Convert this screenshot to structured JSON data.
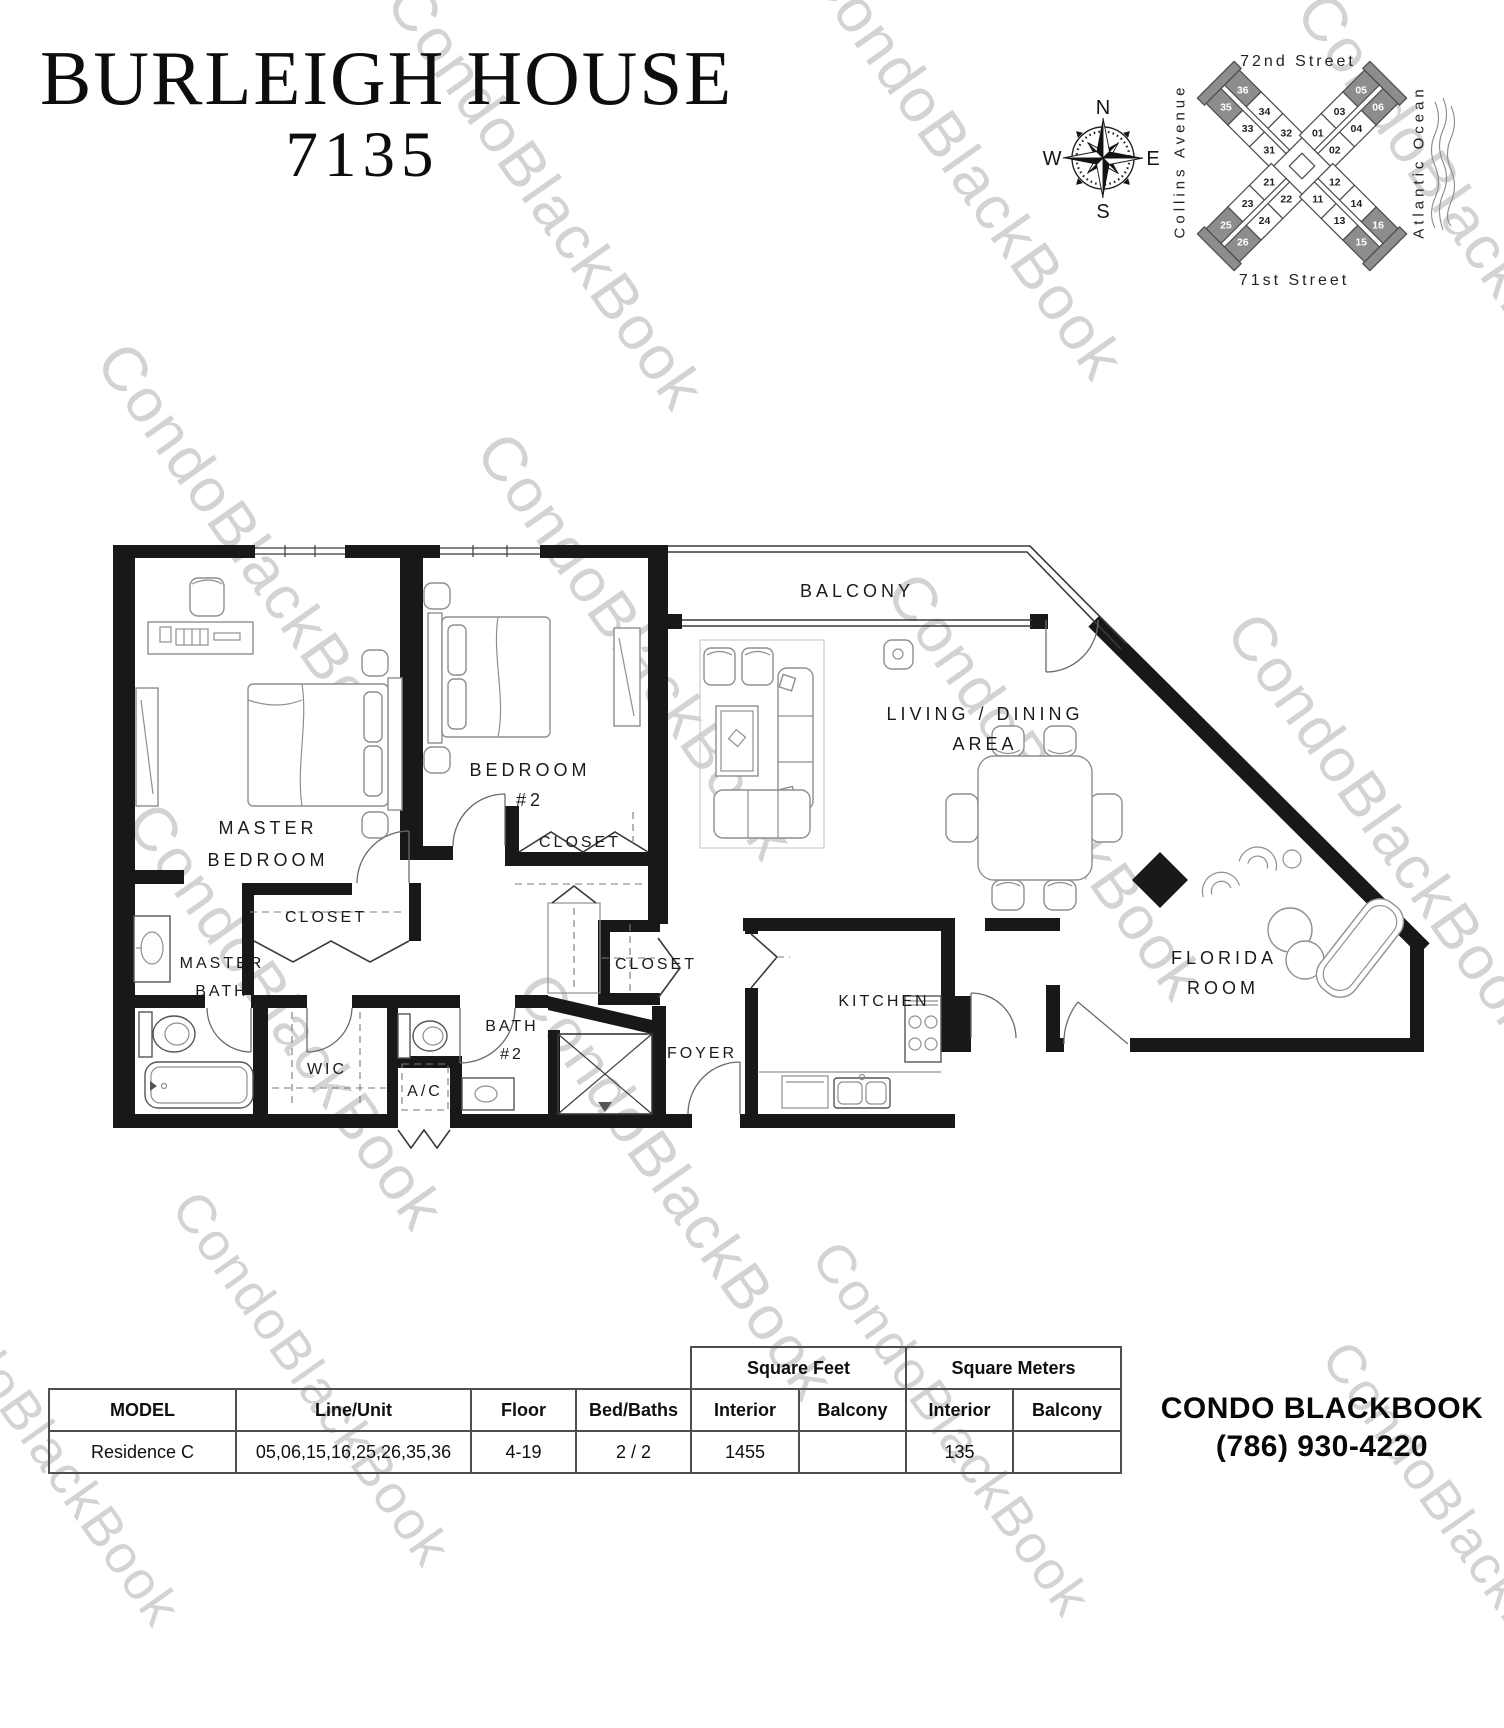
{
  "title": {
    "line1": "BURLEIGH HOUSE",
    "line2": "7135"
  },
  "watermark_text": "CondoBlackBook",
  "compass": {
    "north": "N",
    "east": "E",
    "south": "S",
    "west": "W"
  },
  "map": {
    "street_top": "72nd Street",
    "street_bottom": "71st Street",
    "street_left": "Collins Avenue",
    "ocean_right": "Atlantic Ocean",
    "building": {
      "highlighted_units": [
        "05",
        "06",
        "15",
        "16",
        "25",
        "26",
        "35",
        "36"
      ],
      "dark_color": "#8d8d8d",
      "arms": [
        {
          "angle": -45,
          "left": [
            "35",
            "33",
            "31"
          ],
          "right": [
            "36",
            "34",
            "32"
          ]
        },
        {
          "angle": 45,
          "left": [
            "05",
            "03",
            "01"
          ],
          "right": [
            "06",
            "04",
            "02"
          ]
        },
        {
          "angle": -135,
          "left": [
            "26",
            "24",
            "22"
          ],
          "right": [
            "25",
            "23",
            "21"
          ]
        },
        {
          "angle": 135,
          "left": [
            "16",
            "14",
            "12"
          ],
          "right": [
            "15",
            "13",
            "11"
          ]
        }
      ]
    }
  },
  "floorplan": {
    "labels": {
      "balcony": "BALCONY",
      "master_bedroom_1": "MASTER",
      "master_bedroom_2": "BEDROOM",
      "bedroom2_1": "BEDROOM",
      "bedroom2_2": "#2",
      "closet_bedroom2": "CLOSET",
      "closet_master": "CLOSET",
      "closet_hall": "CLOSET",
      "master_bath_1": "MASTER",
      "master_bath_2": "BATH",
      "wic": "WIC",
      "ac": "A/C",
      "bath2_1": "BATH",
      "bath2_2": "#2",
      "foyer": "FOYER",
      "kitchen": "KITCHEN",
      "living_1": "LIVING / DINING",
      "living_2": "AREA",
      "florida_1": "FLORIDA",
      "florida_2": "ROOM"
    }
  },
  "table": {
    "group_square_feet": "Square Feet",
    "group_square_meters": "Square Meters",
    "headers": [
      "MODEL",
      "Line/Unit",
      "Floor",
      "Bed/Baths",
      "Interior",
      "Balcony",
      "Interior",
      "Balcony"
    ],
    "row": {
      "model": "Residence C",
      "line_unit": "05,06,15,16,25,26,35,36",
      "floor": "4-19",
      "bed_baths": "2 / 2",
      "sqft_interior": "1455",
      "sqft_balcony": "",
      "sqm_interior": "135",
      "sqm_balcony": ""
    }
  },
  "brand": {
    "name": "CONDO BLACKBOOK",
    "phone": "(786) 930-4220"
  }
}
